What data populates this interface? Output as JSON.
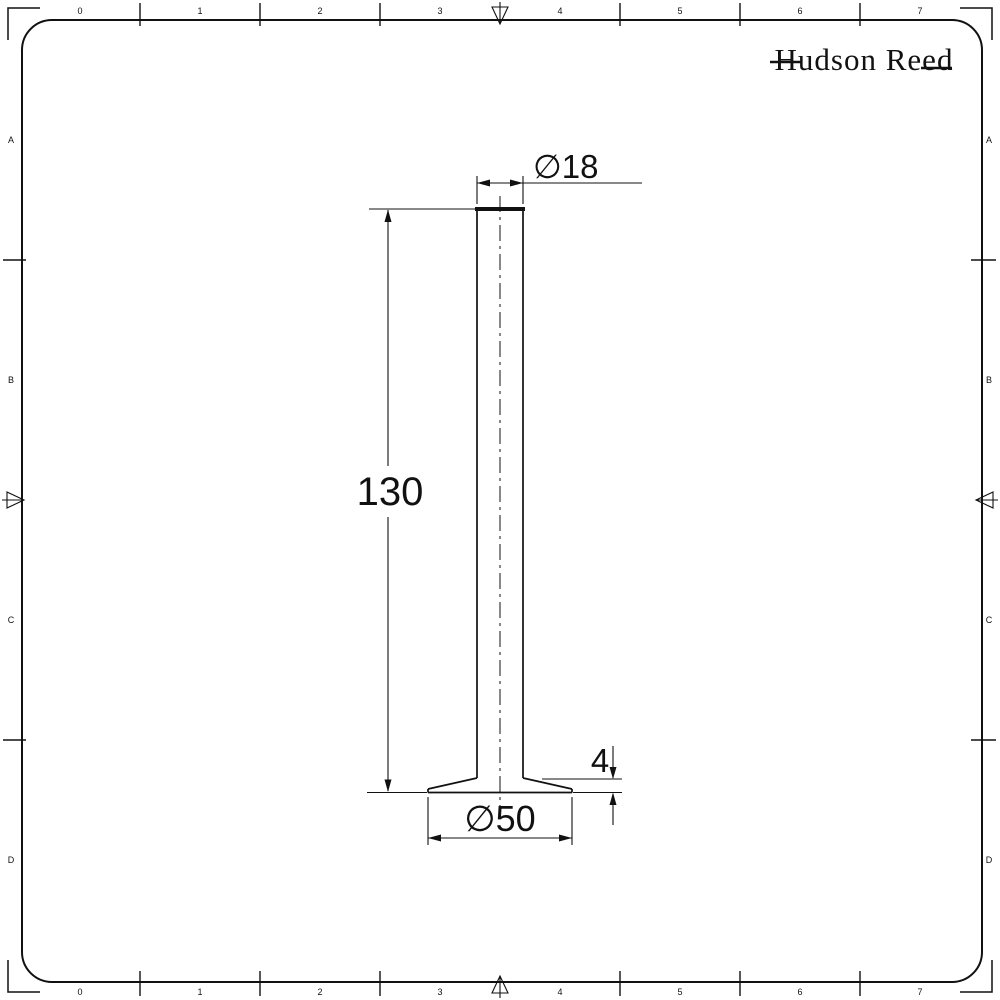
{
  "colors": {
    "ink": "#111111",
    "paper": "#ffffff"
  },
  "brand": {
    "logo_text": "Hudson Reed"
  },
  "sheet": {
    "zone_columns": [
      "0",
      "1",
      "2",
      "3",
      "4",
      "5",
      "6",
      "7"
    ],
    "zone_rows": [
      "A",
      "B",
      "C",
      "D"
    ]
  },
  "drawing": {
    "dimensions": {
      "top_diameter": "∅18",
      "overall_height": "130",
      "flange_thickness": "4",
      "base_diameter": "∅50"
    }
  }
}
